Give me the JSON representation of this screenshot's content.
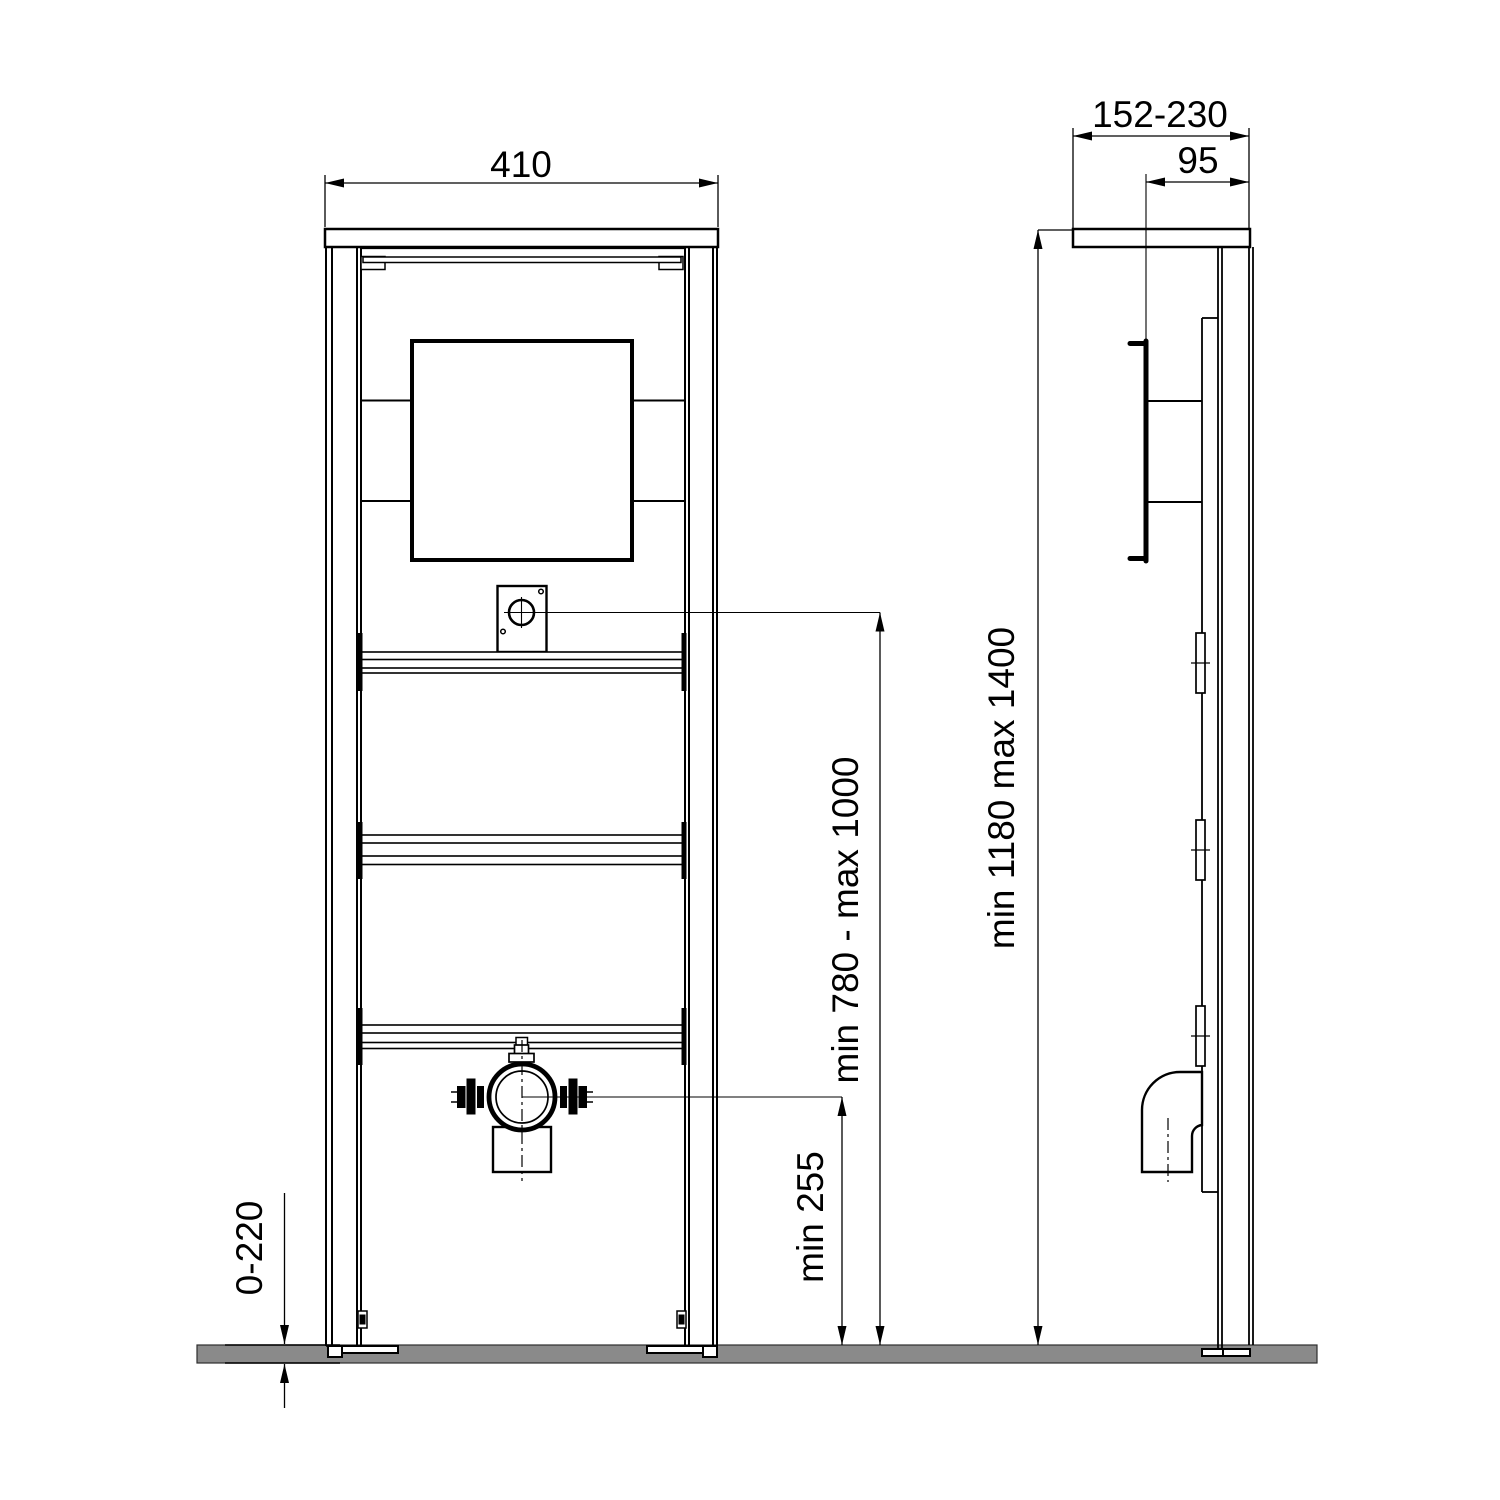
{
  "drawing": {
    "kind": "installation-frame-dimension-drawing",
    "views": {
      "front": "front-view",
      "side": "side-view"
    }
  },
  "dimensions": {
    "frame_width": "410",
    "depth_range": "152-230",
    "actuator_depth": "95",
    "frame_height_range": "min 1180 max 1400",
    "flush_plate_height_range": "min 780 - max 1000",
    "outlet_min_height": "min 255",
    "floor_buildup_range": "0-220"
  },
  "colors": {
    "line": "#000000",
    "floor_fill": "#8a8a8a",
    "floor_edge": "#2e2e2e",
    "background": "#ffffff"
  }
}
